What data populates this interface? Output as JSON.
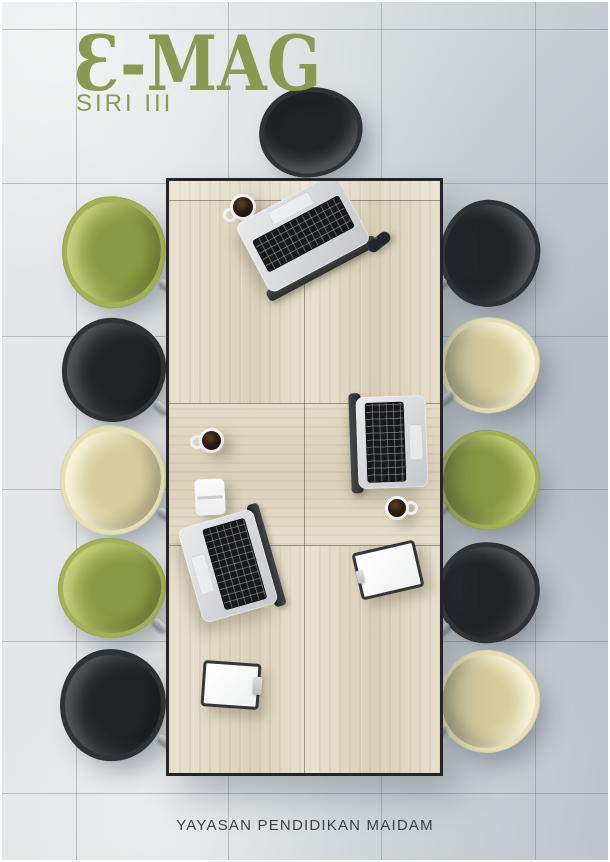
{
  "cover": {
    "title": "E-MAG",
    "title_display": "Ɛ-MAG",
    "series": "SIRI III",
    "footer": "YAYASAN PENDIDIKAN MAIDAM",
    "title_color": "#8a9a52",
    "series_color": "#8a9a52",
    "footer_color": "#3d4144"
  },
  "scene": {
    "description_colors": {
      "floor_light": "#e4e7e8",
      "floor_dark": "#bdc5ca",
      "wood_light": "#e8e1cf",
      "wood_dark": "#d8cdb5",
      "table_border": "#232528"
    },
    "floor": {
      "seam_color": "rgba(108,118,126,0.38)",
      "vertical_seams_x": [
        76,
        228,
        381,
        535
      ],
      "horizontal_seams_y": [
        29,
        183,
        336,
        489,
        641,
        793
      ]
    },
    "table": {
      "x": 166,
      "y": 178,
      "width": 271,
      "height": 592,
      "border_color": "#232528",
      "seam_ys": [
        19,
        222,
        364
      ],
      "center_seam_x": 135,
      "cross_grain_band": {
        "top": 222,
        "height": 142
      }
    },
    "chair_colors": {
      "green": {
        "base": "#a3b056",
        "seat": "#8a9a42",
        "rim": "#ccd584"
      },
      "black": {
        "base": "#303335",
        "seat": "#212426",
        "rim": "#565b5f"
      },
      "cream": {
        "base": "#e6dfb5",
        "seat": "#d6cc9d",
        "rim": "#faf6e2"
      }
    },
    "chairs": [
      {
        "side": "top",
        "color": "black",
        "left": 259,
        "top": 87,
        "width": 104,
        "height": 90,
        "rot": -8
      },
      {
        "side": "left",
        "color": "green",
        "left": 62,
        "top": 196,
        "width": 104,
        "height": 112,
        "rot": -6
      },
      {
        "side": "left",
        "color": "black",
        "left": 62,
        "top": 318,
        "width": 104,
        "height": 104,
        "rot": 3
      },
      {
        "side": "left",
        "color": "cream",
        "left": 60,
        "top": 425,
        "width": 106,
        "height": 110,
        "rot": -4
      },
      {
        "side": "left",
        "color": "green",
        "left": 58,
        "top": 538,
        "width": 108,
        "height": 100,
        "rot": 5
      },
      {
        "side": "left",
        "color": "black",
        "left": 60,
        "top": 649,
        "width": 106,
        "height": 112,
        "rot": -3
      },
      {
        "side": "right",
        "color": "black",
        "left": 440,
        "top": 200,
        "width": 100,
        "height": 107,
        "rot": 6
      },
      {
        "side": "right",
        "color": "cream",
        "left": 440,
        "top": 317,
        "width": 100,
        "height": 96,
        "rot": -4
      },
      {
        "side": "right",
        "color": "green",
        "left": 438,
        "top": 430,
        "width": 102,
        "height": 100,
        "rot": 3
      },
      {
        "side": "right",
        "color": "black",
        "left": 437,
        "top": 542,
        "width": 103,
        "height": 101,
        "rot": -5
      },
      {
        "side": "right",
        "color": "cream",
        "left": 437,
        "top": 650,
        "width": 103,
        "height": 103,
        "rot": 4
      }
    ],
    "items": [
      {
        "type": "cup",
        "cx": 74,
        "cy": 26,
        "d": 26,
        "handle": "bl"
      },
      {
        "type": "laptop",
        "cx": 134,
        "cy": 52,
        "w": 114,
        "h": 78,
        "rot": -28,
        "hinge": "bottom"
      },
      {
        "type": "glasses",
        "cx": 210,
        "cy": 61,
        "w": 26,
        "h": 12,
        "rot": -38
      },
      {
        "type": "cup",
        "cx": 42,
        "cy": 259,
        "d": 25,
        "handle": "left"
      },
      {
        "type": "laptop",
        "cx": 223,
        "cy": 261,
        "w": 70,
        "h": 92,
        "rot": -2,
        "hinge": "left"
      },
      {
        "type": "notepad",
        "cx": 41,
        "cy": 316,
        "w": 30,
        "h": 36,
        "rot": -3
      },
      {
        "type": "cup",
        "cx": 228,
        "cy": 327,
        "d": 24,
        "handle": "right"
      },
      {
        "type": "laptop",
        "cx": 59,
        "cy": 385,
        "w": 78,
        "h": 98,
        "rot": -16,
        "hinge": "right"
      },
      {
        "type": "clipboard",
        "cx": 219,
        "cy": 389,
        "w": 64,
        "h": 48,
        "rot": -13,
        "clip": "left"
      },
      {
        "type": "clipboard",
        "cx": 62,
        "cy": 504,
        "w": 58,
        "h": 46,
        "rot": 4,
        "clip": "right"
      }
    ]
  }
}
